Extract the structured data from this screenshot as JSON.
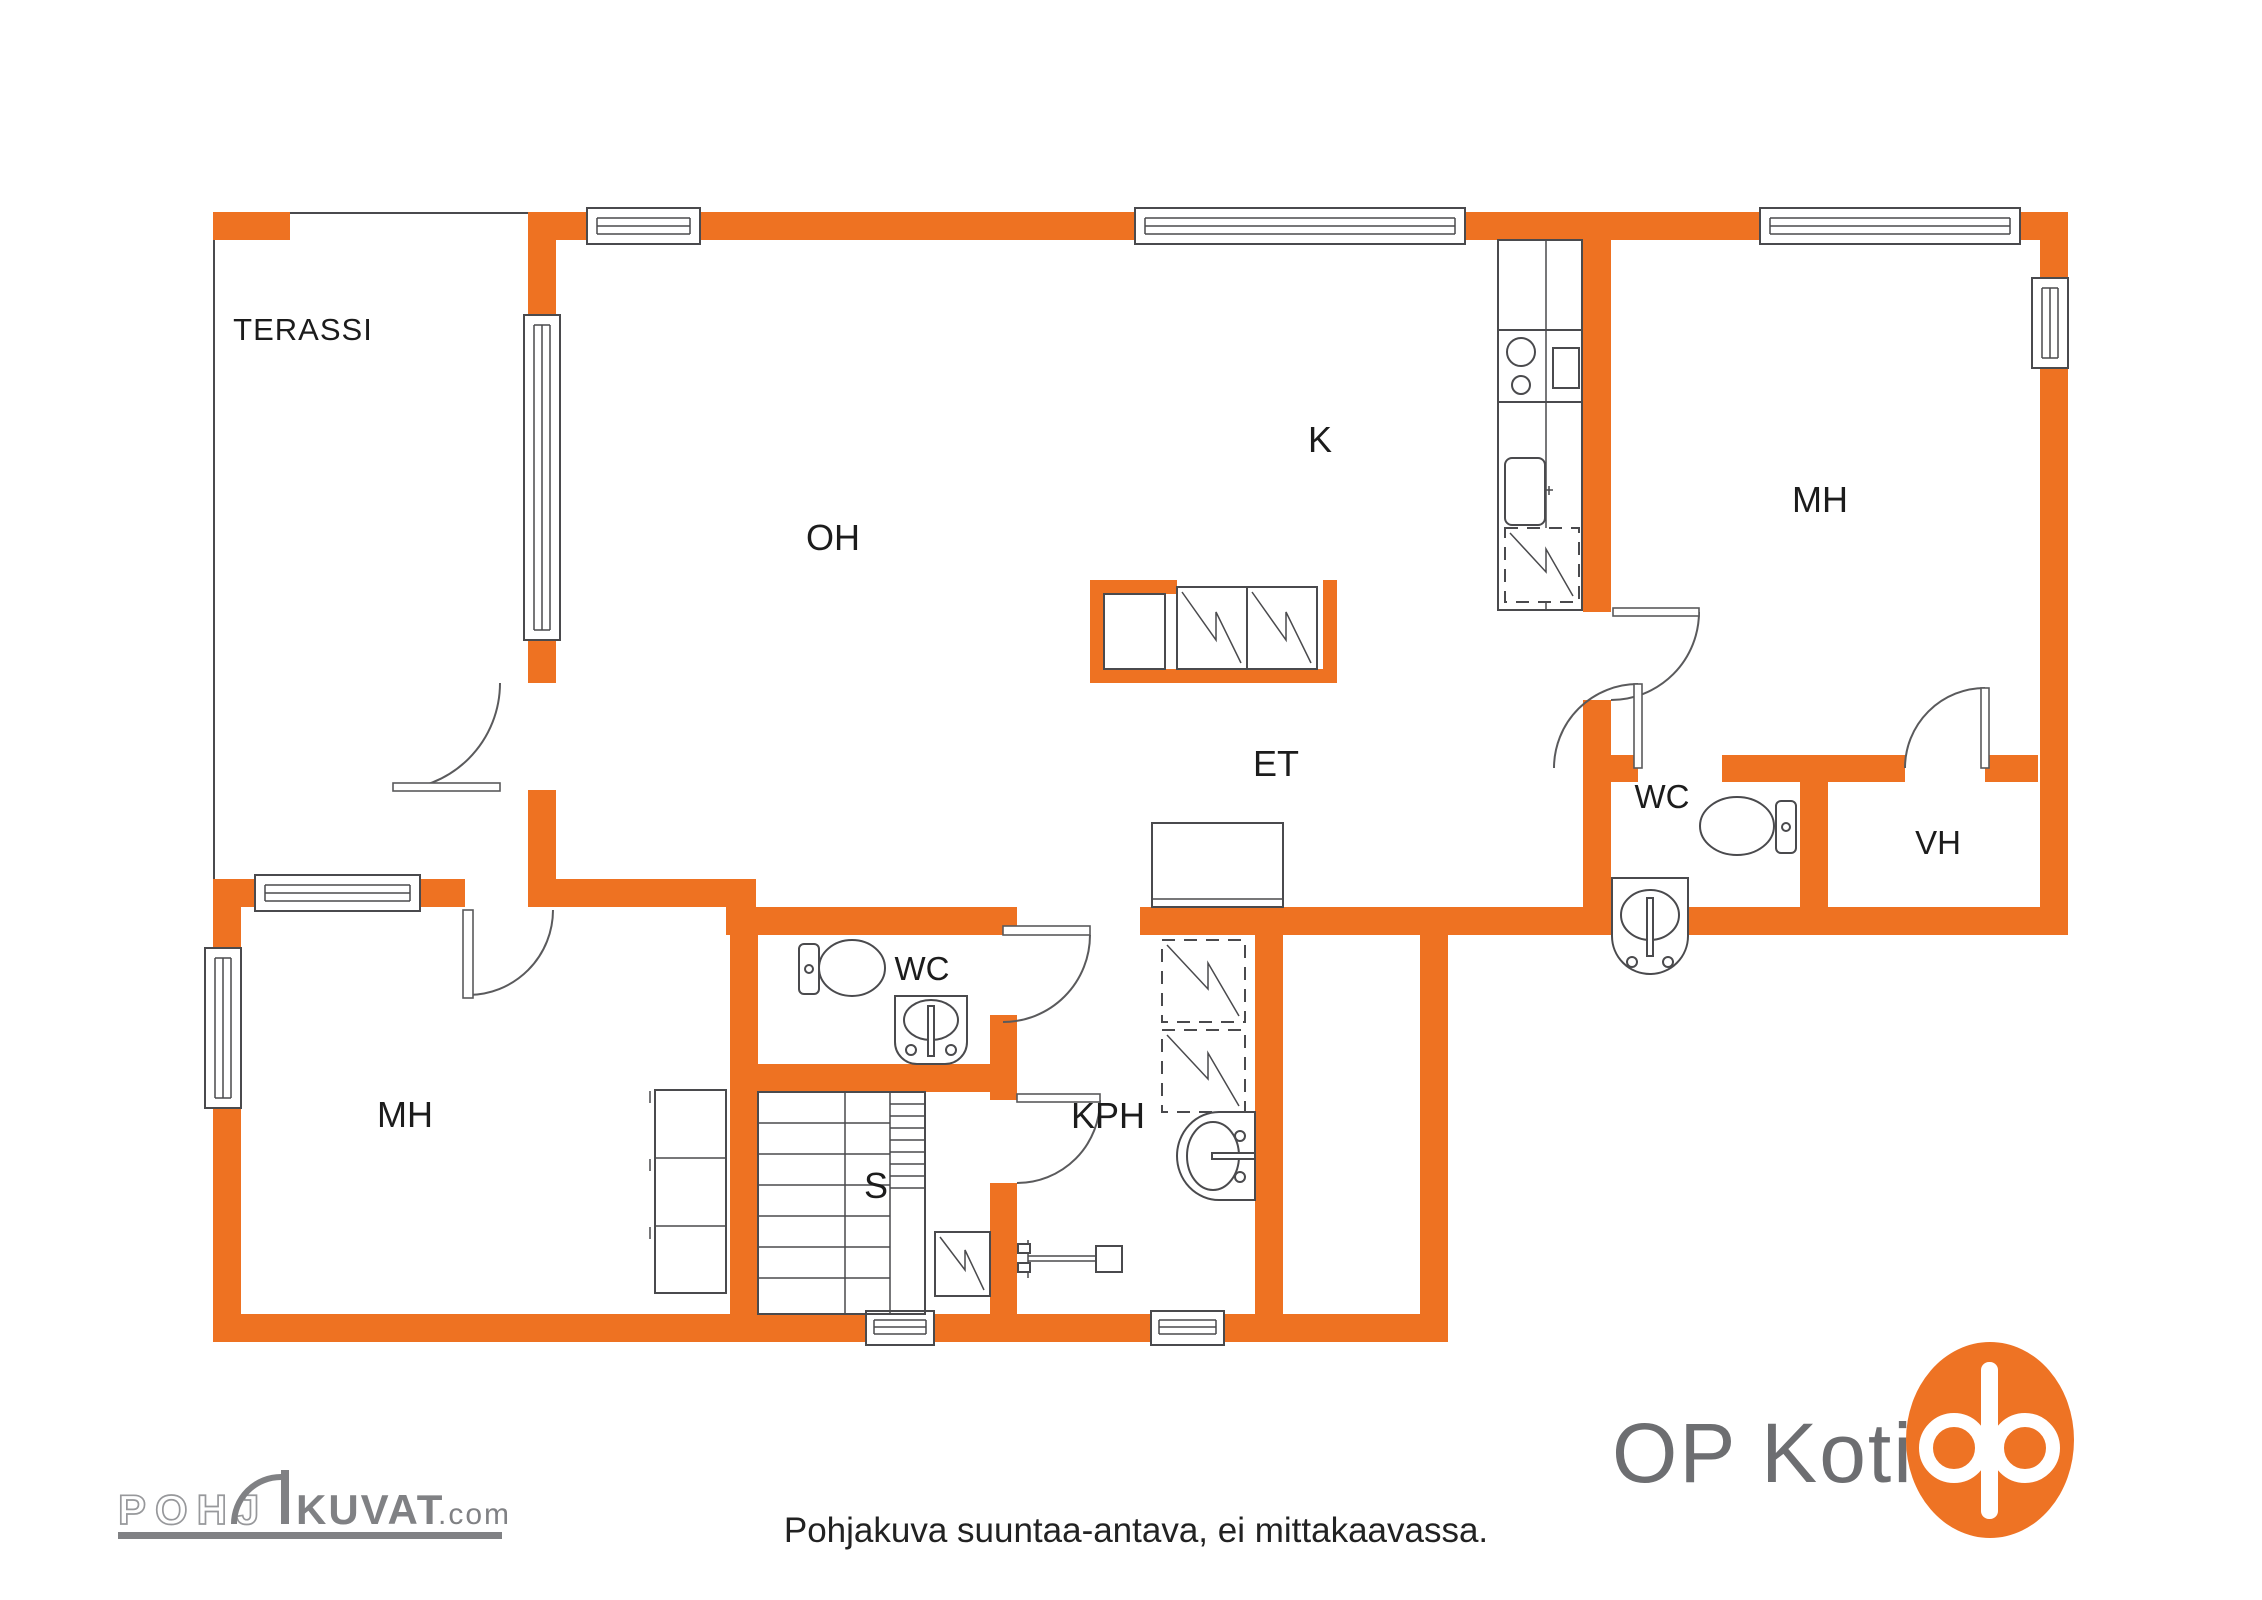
{
  "colors": {
    "wall": "#EE7222",
    "line": "#4A4A4D",
    "label": "#1C1C1C",
    "logo_gray": "#808184",
    "logo_gray_light": "#97989B",
    "op_text_gray": "#6D6E71",
    "op_orange": "#EE7324"
  },
  "rooms": {
    "terassi": "TERASSI",
    "oh": "OH",
    "k": "K",
    "mh_right": "MH",
    "et": "ET",
    "wc_right": "WC",
    "vh": "VH",
    "mh_left": "MH",
    "wc_center": "WC",
    "s": "S",
    "kph": "KPH"
  },
  "footer": {
    "disclaimer": "Pohjakuva suuntaa-antava, ei mittakaavassa."
  },
  "branding": {
    "pohjakuvat_part1": "POHJ",
    "pohjakuvat_part2": "KUVAT",
    "pohjakuvat_suffix": ".com",
    "op_koti": "OP Koti"
  }
}
